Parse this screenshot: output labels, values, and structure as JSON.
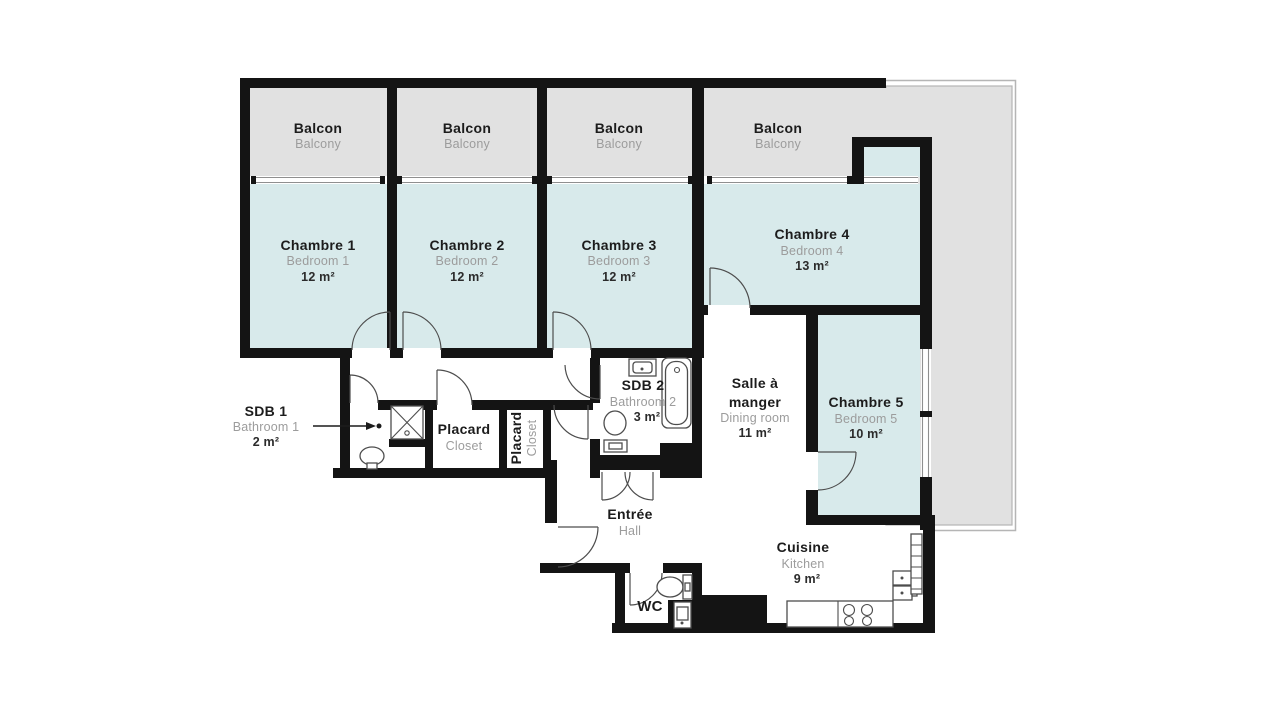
{
  "colors": {
    "wall": "#141414",
    "room": "#d8eaeb",
    "balcony": "#e1e1e1",
    "outline": "#b5b5b5",
    "winline": "#8f8f8f",
    "line": "#4d4d4d",
    "text_dark": "#1c1c1c",
    "text_gray": "#9c9c9c",
    "text_area": "#2b2b2b"
  },
  "rooms": {
    "balcon1": {
      "name": "Balcon",
      "sub": "Balcony"
    },
    "balcon2": {
      "name": "Balcon",
      "sub": "Balcony"
    },
    "balcon3": {
      "name": "Balcon",
      "sub": "Balcony"
    },
    "balcon4": {
      "name": "Balcon",
      "sub": "Balcony"
    },
    "chambre1": {
      "name": "Chambre 1",
      "sub": "Bedroom 1",
      "area": "12 m²"
    },
    "chambre2": {
      "name": "Chambre 2",
      "sub": "Bedroom 2",
      "area": "12 m²"
    },
    "chambre3": {
      "name": "Chambre 3",
      "sub": "Bedroom 3",
      "area": "12 m²"
    },
    "chambre4": {
      "name": "Chambre 4",
      "sub": "Bedroom 4",
      "area": "13 m²"
    },
    "chambre5": {
      "name": "Chambre 5",
      "sub": "Bedroom 5",
      "area": "10 m²"
    },
    "sdb1": {
      "name": "SDB 1",
      "sub": "Bathroom 1",
      "area": "2 m²"
    },
    "sdb2": {
      "name": "SDB 2",
      "sub": "Bathroom 2",
      "area": "3 m²"
    },
    "placard1": {
      "name": "Placard",
      "sub": "Closet"
    },
    "placard2": {
      "name": "Placard",
      "sub": "Closet"
    },
    "entree": {
      "name": "Entrée",
      "sub": "Hall"
    },
    "wc": {
      "name": "WC"
    },
    "salle": {
      "name_line1": "Salle à",
      "name_line2": "manger",
      "sub": "Dining room",
      "area": "11 m²"
    },
    "cuisine": {
      "name": "Cuisine",
      "sub": "Kitchen",
      "area": "9 m²"
    }
  }
}
